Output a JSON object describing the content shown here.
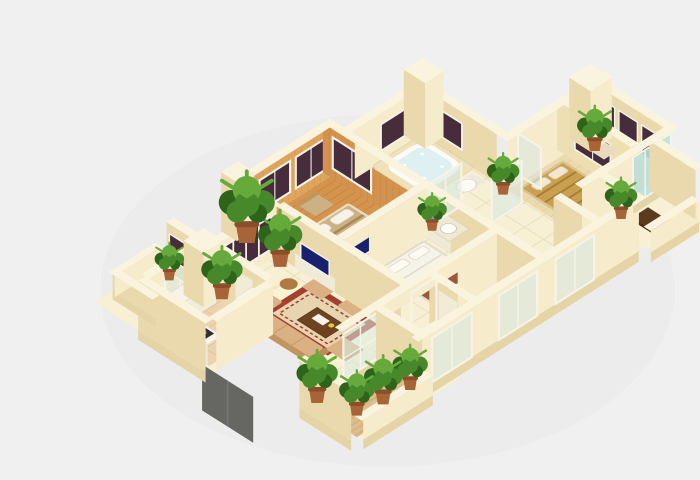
{
  "scene": {
    "type": "isometric-3d-floorplan-render",
    "description": "3D dollhouse-view floor plan of a residential apartment on a plain light gray background",
    "rooms": [
      {
        "name": "master-bedroom",
        "floor": "wood",
        "furniture": [
          "striped double bed",
          "two pillows",
          "tv-cabinet",
          "tv",
          "armchair"
        ],
        "walls": "wood planks with two dark windows"
      },
      {
        "name": "second-bedroom",
        "floor": "tile",
        "furniture": [
          "white double bed",
          "brown foot throw",
          "tv on wall cabinet"
        ]
      },
      {
        "name": "gold-bedroom",
        "floor": "pale wood",
        "furniture": [
          "gold patterned bed",
          "pillows"
        ],
        "walls": "cream with dark window"
      },
      {
        "name": "sunroom-glass-room",
        "floor": "pale wood",
        "furniture": [
          "low chest",
          "plant"
        ],
        "walls": "three dark windows, teal glass front"
      },
      {
        "name": "jacuzzi-bathroom",
        "floor": "tile",
        "furniture": [
          "corner jacuzzi tub",
          "toilet",
          "wash basin"
        ],
        "walls": "cream with small dark windows"
      },
      {
        "name": "living-room",
        "floor": "cream tile",
        "furniture": [
          "red bordered rug",
          "three-seat sofa",
          "two armchairs",
          "side chair",
          "dark coffee table",
          "round side table",
          "tv on cabinet"
        ],
        "walls": "large dark window band"
      },
      {
        "name": "dining-area",
        "floor": "tile",
        "furniture": [
          "wood dining table",
          "six white chairs",
          "place settings"
        ]
      },
      {
        "name": "kitchen",
        "floor": "terracotta tile",
        "furniture": [
          "L-shaped white counter",
          "gas stove",
          "sink",
          "fridge"
        ]
      },
      {
        "name": "small-bathroom-1",
        "floor": "tile",
        "furniture": [
          "white tub",
          "toilet"
        ]
      },
      {
        "name": "small-bathroom-2",
        "floor": "tile",
        "furniture": [
          "shower tray",
          "basin"
        ]
      },
      {
        "name": "kitchen-balcony",
        "floor": "terracotta tile",
        "walls": "dark window over glass slider, low parapets"
      },
      {
        "name": "wood-deck-balcony",
        "floor": "diagonal wood planks",
        "furniture": [
          "row of green plants"
        ],
        "extras": [
          "dark glass balustrade panel below"
        ]
      },
      {
        "name": "front-right-balcony",
        "floor": "tile",
        "furniture": [
          "dark brown bench",
          "potted plant"
        ]
      }
    ],
    "plants_count": 12,
    "glazing": [
      "white framed glass sliders on front walls",
      "white framed glass partitions near corridor",
      "teal glass panels on right wing"
    ]
  },
  "palette": {
    "bg": "#f0f0f1",
    "wallTop": "#faf4de",
    "wallSE": "#f6eccb",
    "wallSW": "#e9d9ad",
    "slab": "#e5d4a6",
    "tile": "#f7f0d4",
    "tileLine": "#e4d8b0",
    "wood": "#d5944e",
    "woodLine": "#b87636",
    "woodWall": "#dfa55e",
    "woodWallShade": "#d3934e",
    "woodPale": "#ecd9ad",
    "terra": "#ecd2ae",
    "terraLine": "#dcbf93",
    "deck": "#dcbd8e",
    "deckLine": "#c9a56c",
    "window_dark": "#472c3c",
    "frame": "#f6f3e8",
    "glass": "#d7e9e3",
    "teal_glass": "#bfe0da",
    "tv_screen": "#18216e",
    "rug_red": "#a54030",
    "rug_inner": "#e7d5b0",
    "sofa": "#d9b183",
    "sofa_dark": "#c2955f",
    "wood_furniture": "#6e4420",
    "white": "#f6f3ea",
    "gold_bed": "#c9a052",
    "bed_stripe": "#a98a55",
    "bed_base": "#cbb184",
    "plant_dark": "#2d6419",
    "plant": "#47892a",
    "plant_light": "#66aa3c",
    "pot": "#a86336",
    "dark_glass_panel": "#5e5e5a",
    "stove": "#2e2e2e"
  }
}
